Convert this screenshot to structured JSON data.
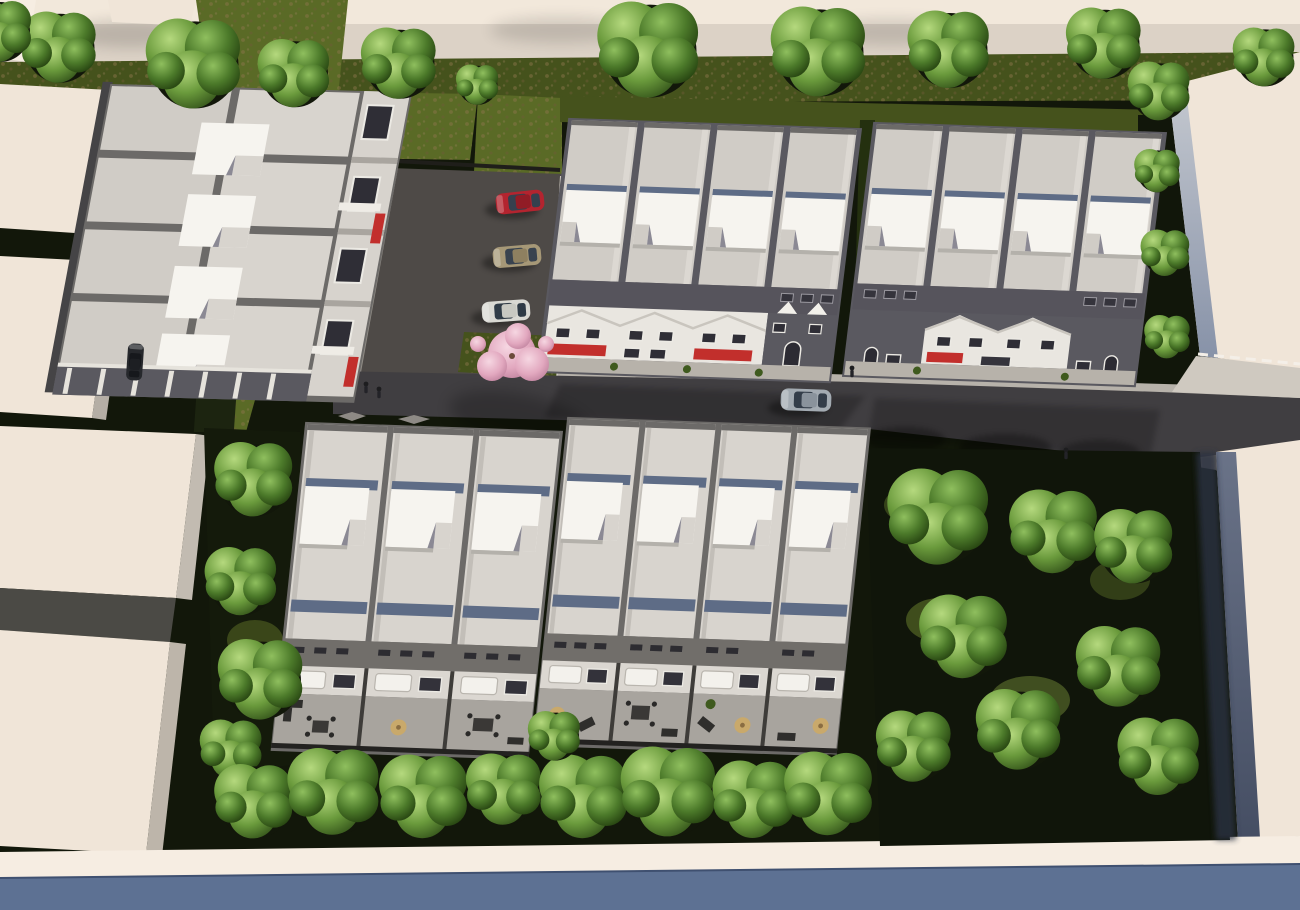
{
  "meta": {
    "title": "Aerial 3D rendering of a townhouse development",
    "type": "architectural-visualization",
    "view": "top-down oblique bird's-eye",
    "lighting": "daytime sun from upper right, shadows cast to lower-left"
  },
  "palette": {
    "top-band": "#dcd2c6",
    "top-band-light": "#f2e8db",
    "grass": "#5a6a26",
    "grass-dark": "#45521c",
    "ground-dark": "#12170a",
    "asphalt": "#4e4a47",
    "road": "#403e41",
    "walk": "#b7b2aa",
    "kerb": "#cfc9c0",
    "ridge": "#6c6a68",
    "roof-a": "#d0ccc6",
    "roof-b": "#d8d4ce",
    "roofbox": "#f6f4ef",
    "slopeblue": "#5e6c86",
    "slope-dark": "#56545c",
    "facade-dark": "#5a5960",
    "facade-white": "#e9e6e0",
    "stone": "#d7d3cd",
    "window": "#2f2e36",
    "frame": "#eceae4",
    "flower": "#c22f2c",
    "cream": "#f0e5d8",
    "cream2": "#f6ede2",
    "wallshade": "#97a2b6",
    "wallshade-dark": "#515b72",
    "blueband": "#5d7193",
    "face-gray": "#b5aea5",
    "yard": "#a8a49e",
    "fence": "#3e3c39",
    "awning": "#f3f1ec",
    "furn": "#2f2e2c",
    "parasol": "#c9a96b",
    "drive-light": "#6d6862"
  },
  "scene": {
    "buildings": [
      {
        "id": "top-left-block",
        "kind": "row-houses",
        "roof_boxes": 4,
        "roof_slabs": 8,
        "facade": "stone white with red flower boxes facing parking"
      },
      {
        "id": "top-middle-row",
        "kind": "townhouses",
        "units": 4,
        "facade": "three white gable fronts + one dark brick end unit, red flower boxes"
      },
      {
        "id": "top-right-row",
        "kind": "townhouses",
        "units": 4,
        "facade": "dark brick ends with two white gable middle units, red flower box"
      },
      {
        "id": "bottom-left-row",
        "kind": "townhouses",
        "units": 3,
        "facade": "rear yards with patios, awnings and furniture"
      },
      {
        "id": "bottom-middle-row",
        "kind": "townhouses",
        "units": 4,
        "facade": "rear yards with patios, parasols and furniture"
      }
    ],
    "neighbor_buildings": [
      "cream flat-roof massing blocks on left edge",
      "large cream block top-right",
      "cream block bottom-right",
      "long cream strip along bottom"
    ],
    "vehicles": [
      {
        "name": "red-car",
        "state": "parked in lot",
        "body": "#b3242f",
        "glass": "#35404e",
        "roof": "#911c26"
      },
      {
        "name": "beige-car",
        "state": "parked in lot",
        "body": "#a69877",
        "glass": "#39434f",
        "roof": "#8e8060"
      },
      {
        "name": "white-car",
        "state": "parked in lot",
        "body": "#d9d9d3",
        "glass": "#2f3b46",
        "roof": "#c8c9c2"
      },
      {
        "name": "silver-car",
        "state": "driving on street",
        "body": "#a3abb2",
        "glass": "#333d49",
        "roof": "#8a939c"
      },
      {
        "name": "dark-car",
        "state": "parked at left alley",
        "body": "#26282c",
        "glass": "#16181c",
        "roof": "#1d1f23"
      }
    ],
    "vegetation": {
      "cherry_tree": 1,
      "green_trees_approx": 34,
      "hedges": "fence-line hedge left of site, bushes right of top-right row",
      "lawns": "mottled green strips around buildings, dense dark garden at right and bottom"
    },
    "roads": {
      "main_street": "dark asphalt, runs left-to-right across middle, slight downhill tilt to right",
      "parking_lot": "asphalt court with 3 stalls between top-left block and top-middle row",
      "markings": "two pale diamond pavement markings at west end of street",
      "sidewalk": "pale strip along front of upper townhouse rows"
    },
    "people": {
      "pedestrians": 4
    }
  }
}
